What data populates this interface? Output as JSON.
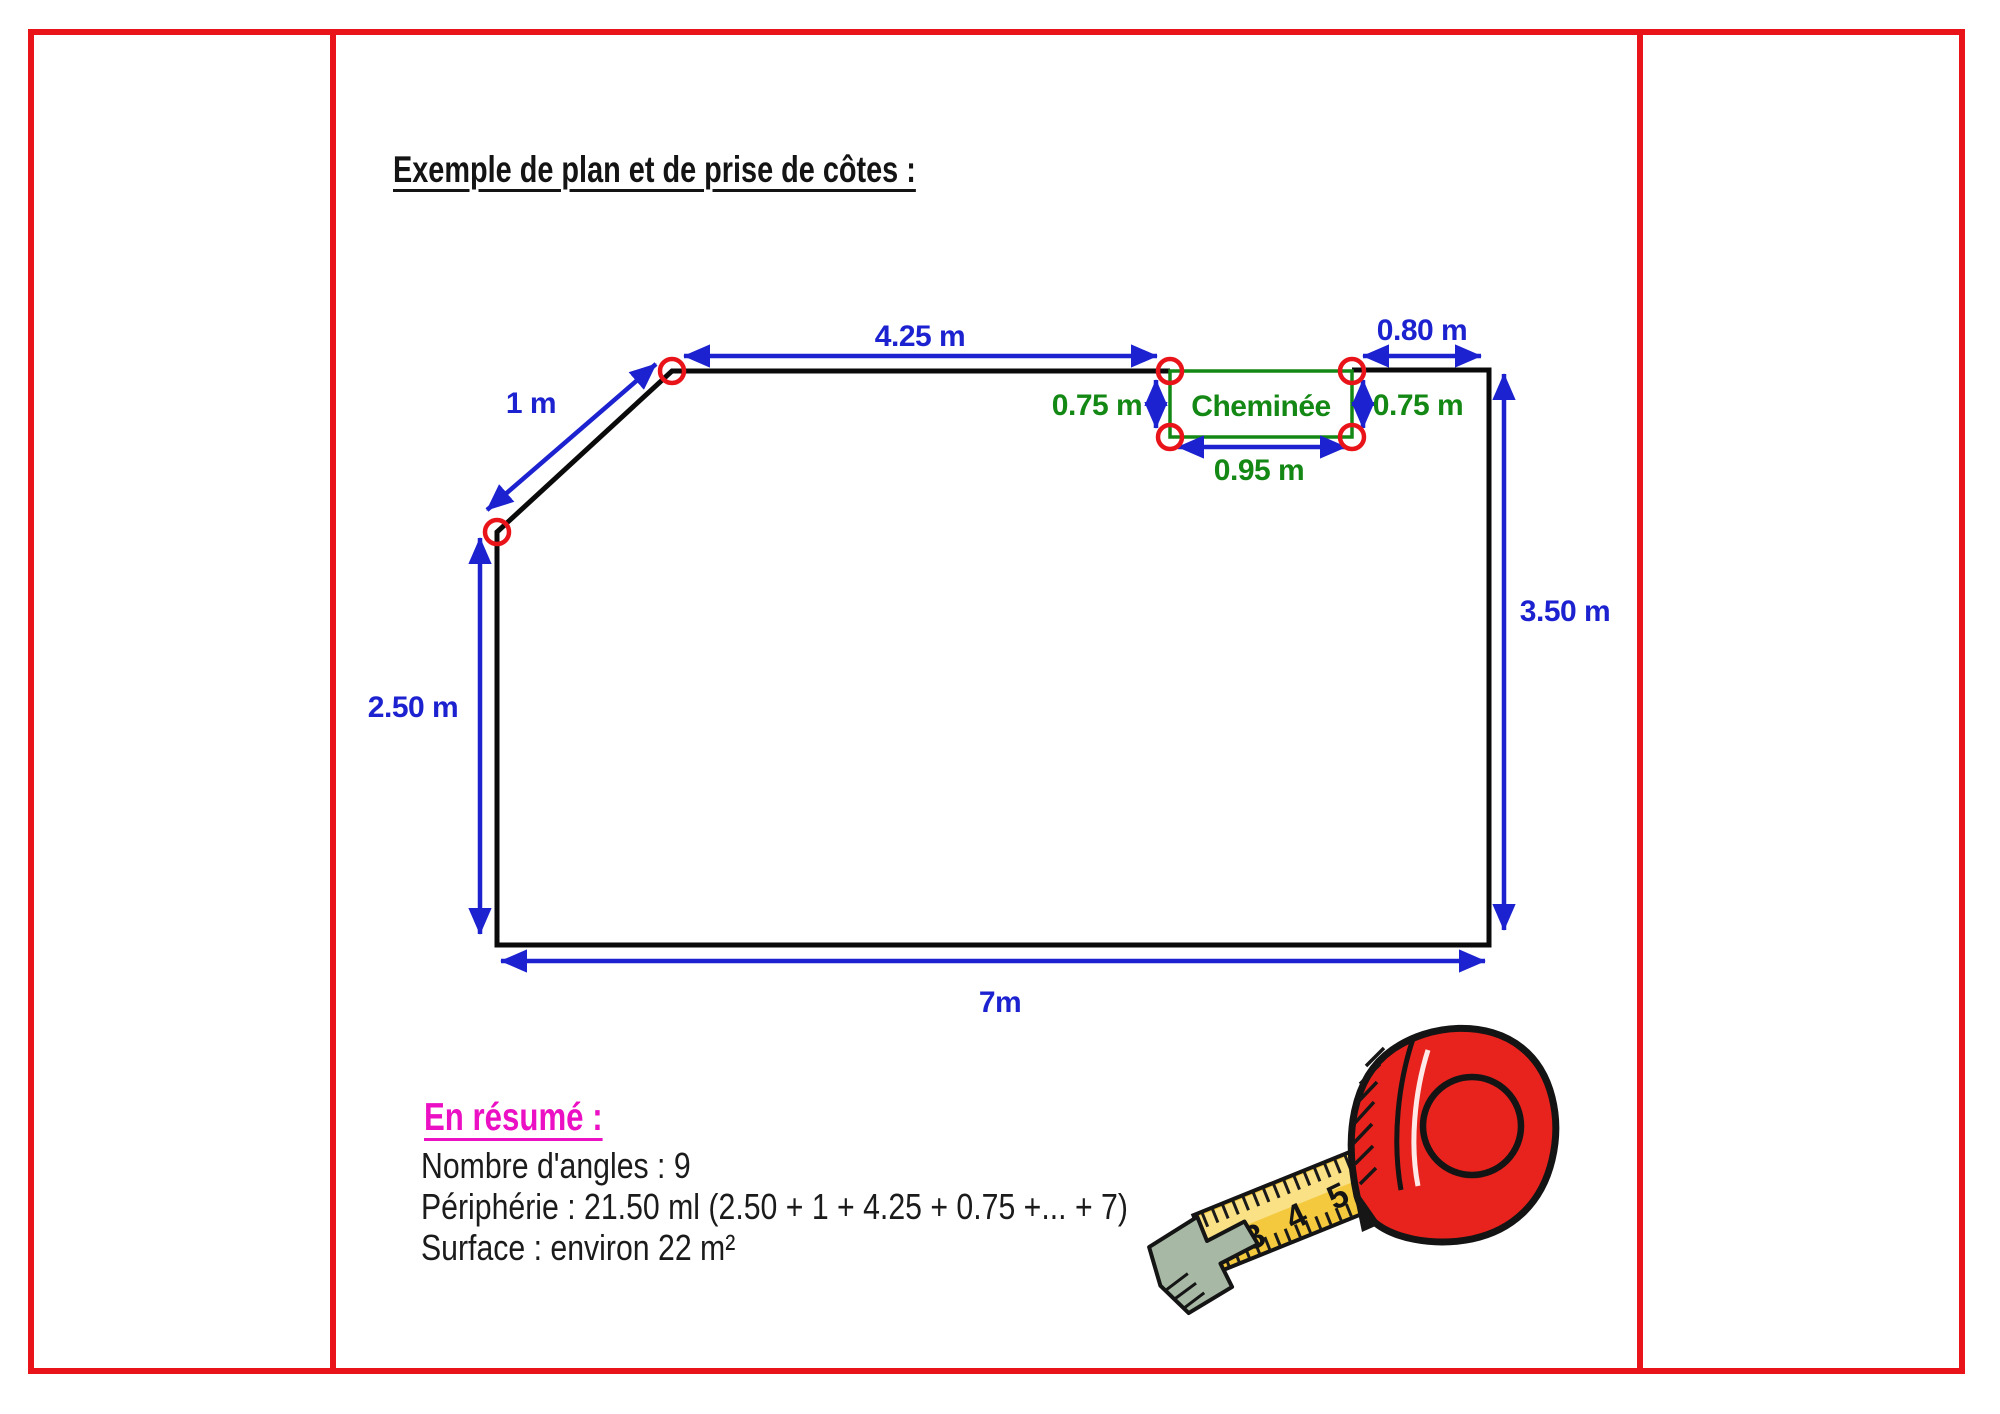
{
  "title": "Exemple de plan et de prise de côtes :",
  "plan": {
    "labels": {
      "top": "4.25 m",
      "top_right": "0.80 m",
      "diagonal": "1 m",
      "chimney_left": "0.75 m",
      "chimney_right": "0.75 m",
      "chimney_width": "0.95 m",
      "chimney": "Cheminée",
      "left": "2.50 m",
      "right": "3.50 m",
      "bottom": "7m"
    },
    "colors": {
      "wall": "#0a0a0a",
      "dimension_blue": "#1c22cf",
      "chimney_green": "#148814",
      "angle_marker_red": "#e9141a",
      "frame_red": "#e9141a"
    },
    "angle_marker_count": 6
  },
  "summary": {
    "heading": "En résumé :",
    "lines": [
      "Nombre d'angles : 9",
      "Périphérie : 21.50 ml (2.50 + 1 + 4.25 + 0.75 +... + 7)",
      "Surface : environ 22 m²"
    ]
  },
  "tape": {
    "numbers": "3 4 5"
  }
}
